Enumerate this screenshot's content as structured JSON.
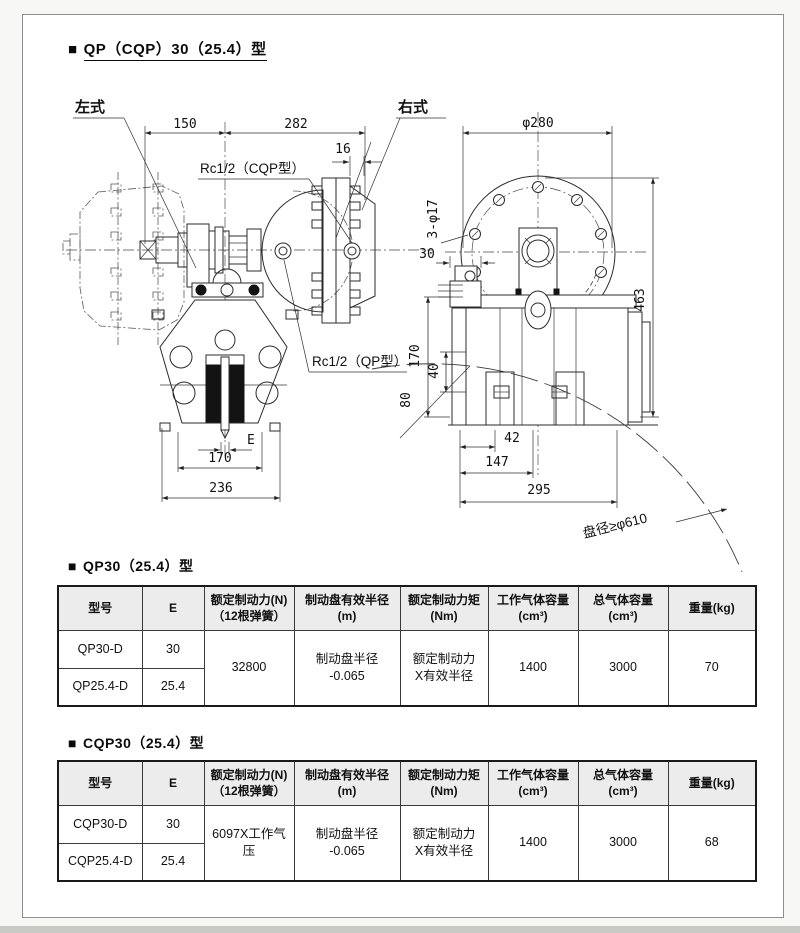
{
  "page": {
    "title_marker": "■",
    "title_text": "QP（CQP）30（25.4）型"
  },
  "drawing": {
    "left_view_label": "左式",
    "right_view_label": "右式",
    "port_cqp": "Rc1/2（CQP型）",
    "port_qp": "Rc1/2（QP型）",
    "dims": {
      "d150": "150",
      "d282": "282",
      "d16": "16",
      "e": "E",
      "d170_left": "170",
      "d236": "236",
      "phi280": "φ280",
      "holes": "3-φ17",
      "d30": "30",
      "d170_right": "170",
      "d40": "40",
      "d80": "80",
      "d463": "463",
      "d42": "42",
      "d147": "147",
      "d295": "295",
      "disc_note": "盘径≥φ610"
    }
  },
  "table_qp": {
    "title_marker": "■",
    "title_text": "QP30（25.4）型",
    "headers": [
      "型号",
      "E",
      "额定制动力(N)\n（12根弹簧）",
      "制动盘有效半径\n(m)",
      "额定制动力矩\n(Nm)",
      "工作气体容量\n(cm³)",
      "总气体容量\n(cm³)",
      "重量(kg)"
    ],
    "rows": [
      {
        "model": "QP30-D",
        "e": "30"
      },
      {
        "model": "QP25.4-D",
        "e": "25.4"
      }
    ],
    "merged": {
      "force": "32800",
      "radius": "制动盘半径\n-0.065",
      "torque": "额定制动力\nX有效半径",
      "work_volume": "1400",
      "total_volume": "3000",
      "weight": "70"
    }
  },
  "table_cqp": {
    "title_marker": "■",
    "title_text": "CQP30（25.4）型",
    "headers": [
      "型号",
      "E",
      "额定制动力(N)\n（12根弹簧）",
      "制动盘有效半径\n(m)",
      "额定制动力矩\n(Nm)",
      "工作气体容量\n(cm³)",
      "总气体容量\n(cm³)",
      "重量(kg)"
    ],
    "rows": [
      {
        "model": "CQP30-D",
        "e": "30"
      },
      {
        "model": "CQP25.4-D",
        "e": "25.4"
      }
    ],
    "merged": {
      "force": "6097X工作气压",
      "radius": "制动盘半径\n-0.065",
      "torque": "额定制动力\nX有效半径",
      "work_volume": "1400",
      "total_volume": "3000",
      "weight": "68"
    }
  }
}
